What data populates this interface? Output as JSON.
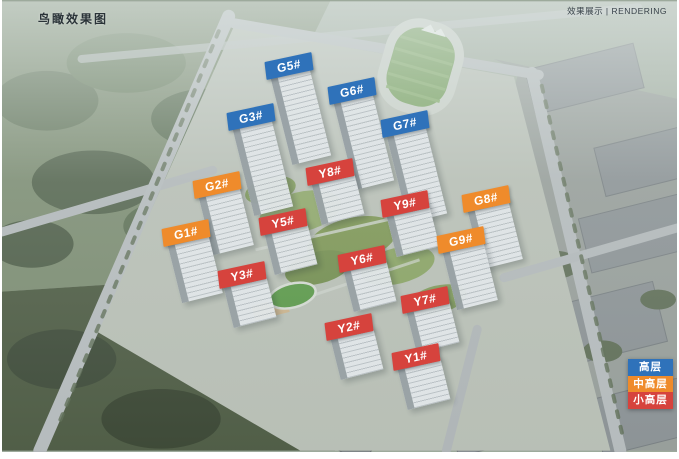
{
  "page": {
    "title": "鸟瞰效果图",
    "watermark": "效果展示 | RENDERING"
  },
  "colors": {
    "high": "#2f72ba",
    "mid": "#ef8b2b",
    "small": "#d6433d"
  },
  "legend": [
    {
      "label": "高层",
      "type": "high"
    },
    {
      "label": "中高层",
      "type": "mid"
    },
    {
      "label": "小高层",
      "type": "small"
    }
  ],
  "buildings": [
    {
      "label": "G5#",
      "type": "high",
      "x": 287,
      "y": 66
    },
    {
      "label": "G6#",
      "type": "high",
      "x": 350,
      "y": 91
    },
    {
      "label": "G3#",
      "type": "high",
      "x": 249,
      "y": 117
    },
    {
      "label": "G7#",
      "type": "high",
      "x": 403,
      "y": 124
    },
    {
      "label": "Y8#",
      "type": "small",
      "x": 328,
      "y": 172
    },
    {
      "label": "G2#",
      "type": "mid",
      "x": 215,
      "y": 185
    },
    {
      "label": "G8#",
      "type": "mid",
      "x": 484,
      "y": 199
    },
    {
      "label": "Y9#",
      "type": "small",
      "x": 403,
      "y": 204
    },
    {
      "label": "Y5#",
      "type": "small",
      "x": 281,
      "y": 222
    },
    {
      "label": "G1#",
      "type": "mid",
      "x": 184,
      "y": 233
    },
    {
      "label": "G9#",
      "type": "mid",
      "x": 459,
      "y": 240
    },
    {
      "label": "Y6#",
      "type": "small",
      "x": 360,
      "y": 259
    },
    {
      "label": "Y3#",
      "type": "small",
      "x": 240,
      "y": 275
    },
    {
      "label": "Y7#",
      "type": "small",
      "x": 423,
      "y": 300
    },
    {
      "label": "Y2#",
      "type": "small",
      "x": 347,
      "y": 327
    },
    {
      "label": "Y1#",
      "type": "small",
      "x": 414,
      "y": 357
    }
  ]
}
